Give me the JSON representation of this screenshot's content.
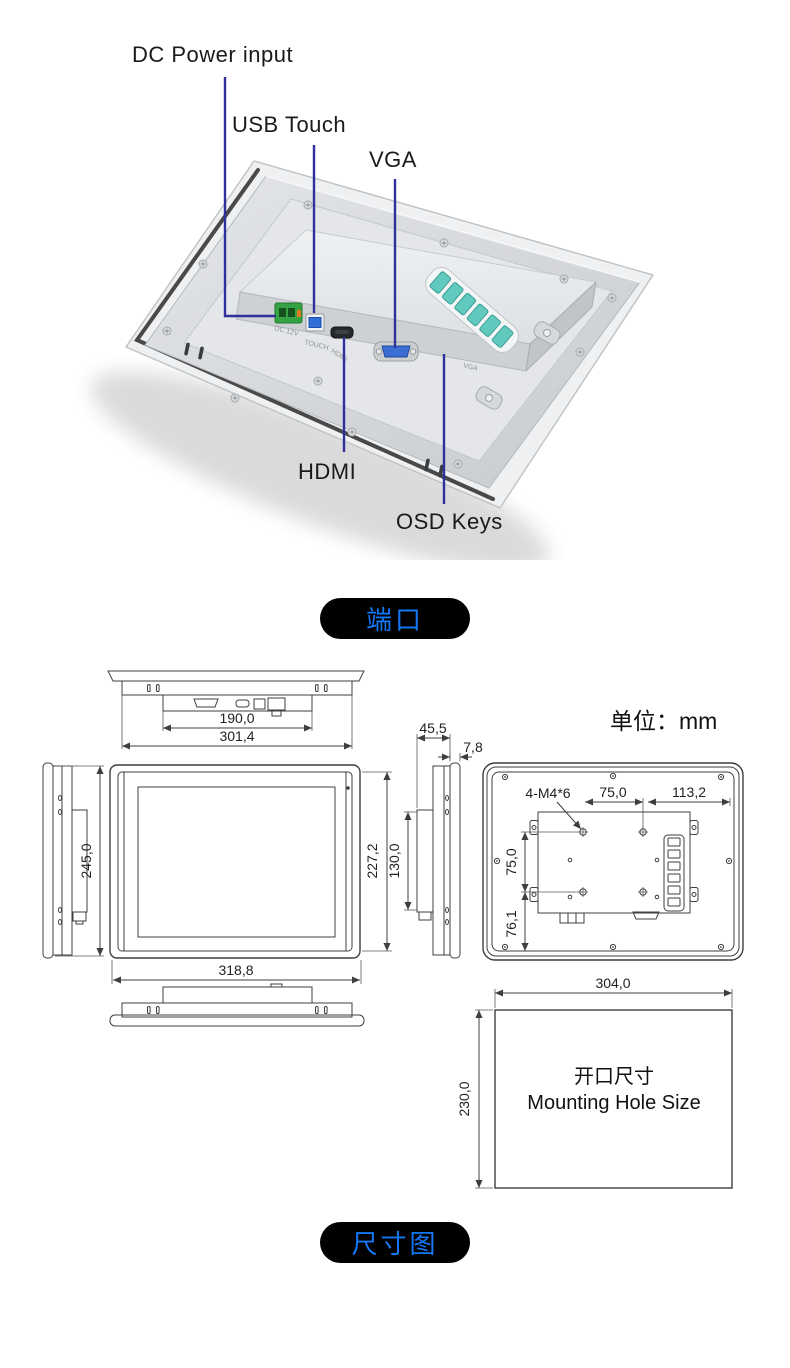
{
  "colors": {
    "accent_blue": "#1478f6",
    "leader_line": "#30309c",
    "badge_bg": "#000000",
    "osd_teal": "#62c9bf",
    "dc_green": "#35a244",
    "usb_blue": "#2f6fd6",
    "vga_blue": "#3a6ed2"
  },
  "section_ports": {
    "badge": "端口",
    "labels": {
      "dc": "DC Power input",
      "usb": "USB Touch",
      "vga": "VGA",
      "hdmi": "HDMI",
      "osd": "OSD Keys"
    },
    "etched": {
      "dc": "DC 12V",
      "touch": "TOUCH",
      "hdmi": "HDMI",
      "vga": "VGA"
    }
  },
  "section_dimensions": {
    "badge": "尺寸图",
    "unit_label": "单位：mm",
    "top_view": {
      "inner_width": "190,0",
      "outer_width": "301,4"
    },
    "side_view_left": {
      "height": "245,0"
    },
    "front_view": {
      "width": "318,8",
      "body_height": "227,2"
    },
    "side_view_right": {
      "total_depth": "45,5",
      "bezel_depth": "7,8",
      "bracket_height": "130,0"
    },
    "rear_view": {
      "vesa_screws": "4-M4*6",
      "hole_pitch_h": "75,0",
      "edge_offset": "113,2",
      "hole_pitch_v": "75,0",
      "bottom_offset": "76,1"
    },
    "mounting_hole": {
      "width": "304,0",
      "height": "230,0",
      "title_cn": "开口尺寸",
      "title_en": "Mounting Hole Size"
    }
  }
}
